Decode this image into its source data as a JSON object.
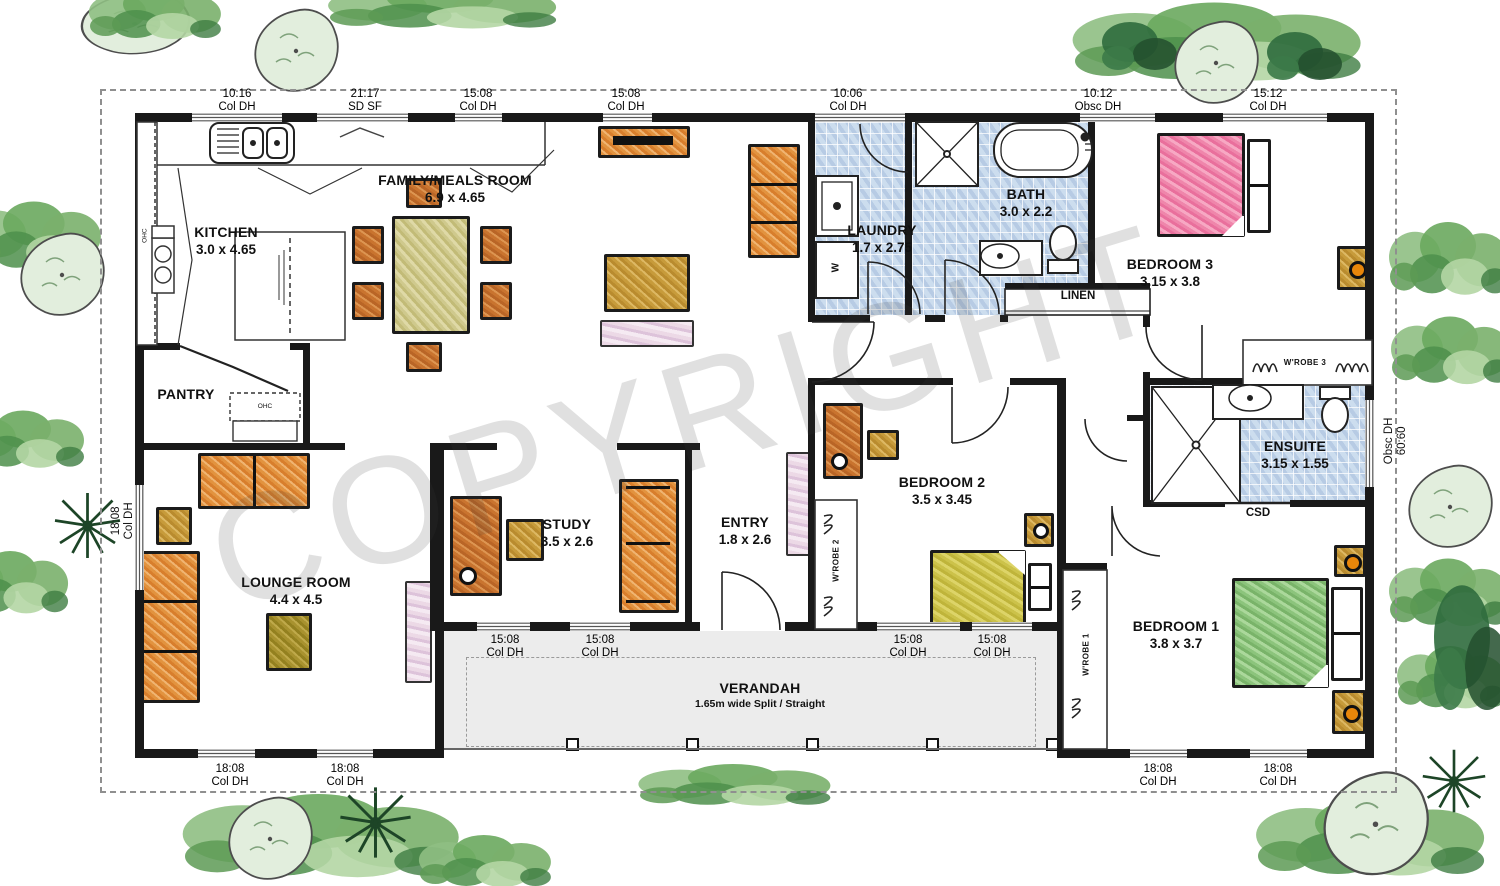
{
  "watermark": {
    "text": "COPYRIGHT"
  },
  "rooms": {
    "kitchen": {
      "name": "KITCHEN",
      "dims": "3.0 x 4.65"
    },
    "family": {
      "name": "FAMILY/MEALS ROOM",
      "dims": "6.9 x 4.65"
    },
    "laundry": {
      "name": "LAUNDRY",
      "dims": "1.7 x 2.75"
    },
    "bath": {
      "name": "BATH",
      "dims": "3.0 x 2.2"
    },
    "bedroom3": {
      "name": "BEDROOM 3",
      "dims": "3.15 x 3.8"
    },
    "bedroom2": {
      "name": "BEDROOM 2",
      "dims": "3.5 x 3.45"
    },
    "bedroom1": {
      "name": "BEDROOM 1",
      "dims": "3.8 x 3.7"
    },
    "study": {
      "name": "STUDY",
      "dims": "3.5 x 2.6"
    },
    "entry": {
      "name": "ENTRY",
      "dims": "1.8 x 2.6"
    },
    "lounge": {
      "name": "LOUNGE ROOM",
      "dims": "4.4 x 4.5"
    },
    "ensuite": {
      "name": "ENSUITE",
      "dims": "3.15 x 1.55"
    },
    "pantry": {
      "name": "PANTRY"
    },
    "verandah": {
      "name": "VERANDAH",
      "note": "1.65m wide Split / Straight"
    }
  },
  "closets": {
    "linen": "LINEN",
    "wrobe1": "W'ROBE 1",
    "wrobe2": "W'ROBE 2",
    "wrobe3": "W'ROBE 3",
    "csd": "CSD",
    "ohc_kitchen": "OHC",
    "ohc_pantry": "OHC"
  },
  "appliances": {
    "washer": "W"
  },
  "window_labels": {
    "top": [
      {
        "size": "10:16",
        "type": "Col DH",
        "cx": 237
      },
      {
        "size": "21:17",
        "type": "SD SF",
        "cx": 365
      },
      {
        "size": "15:08",
        "type": "Col DH",
        "cx": 478
      },
      {
        "size": "15:08",
        "type": "Col DH",
        "cx": 626
      },
      {
        "size": "10:06",
        "type": "Col DH",
        "cx": 848
      },
      {
        "size": "10:12",
        "type": "Obsc DH",
        "cx": 1098
      },
      {
        "size": "15:12",
        "type": "Col DH",
        "cx": 1268
      }
    ],
    "front": [
      {
        "size": "15:08",
        "type": "Col DH",
        "cx": 505
      },
      {
        "size": "15:08",
        "type": "Col DH",
        "cx": 600
      },
      {
        "size": "15:08",
        "type": "Col DH",
        "cx": 908
      },
      {
        "size": "15:08",
        "type": "Col DH",
        "cx": 992
      }
    ],
    "bottom": [
      {
        "size": "18:08",
        "type": "Col DH",
        "cx": 230
      },
      {
        "size": "18:08",
        "type": "Col DH",
        "cx": 345
      },
      {
        "size": "18:08",
        "type": "Col DH",
        "cx": 1158
      },
      {
        "size": "18:08",
        "type": "Col DH",
        "cx": 1278
      }
    ],
    "left": {
      "size": "18:08",
      "type": "Col DH"
    },
    "right": {
      "type": "Obsc DH",
      "size": "60:60"
    }
  },
  "colors": {
    "tile": "#ccddee",
    "verandah_floor": "#ececec",
    "wall": "#191919",
    "watermark": "rgba(60,60,60,0.16)",
    "garden_green": "#6aa85e"
  }
}
